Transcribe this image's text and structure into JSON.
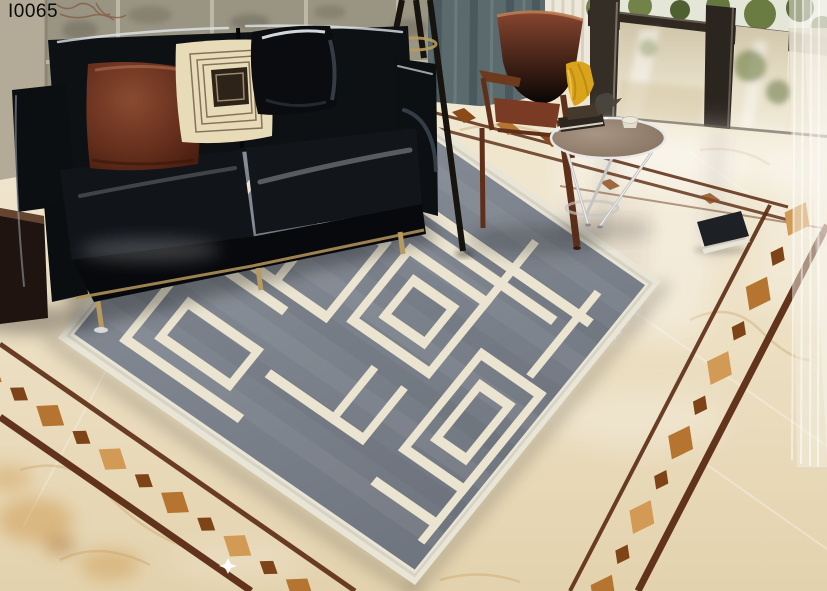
{
  "label": {
    "text": "I0065"
  },
  "palette": {
    "wall_stone": "#9a9583",
    "pillar": "#b3ab97",
    "curtain_teal": "#5b6a6d",
    "curtain_sheer": "#f3efe3",
    "window_frame": "#342e26",
    "greenery": "#66773f",
    "floor_marble": "#ecdfc2",
    "marble_vein": "#c49e5f",
    "border_line_brown": "#5b2b13",
    "border_diamond_gold": "#b5742f",
    "rug_gray": "#7d838d",
    "rug_line": "#eae4d0",
    "rug_edge": "#e9e5d6",
    "sofa_black": "#0e1114",
    "pillow_brown": "#6e3522",
    "pillow_cream": "#e8dbb8",
    "pillow_black": "#0a0c0f",
    "chair_leather": "#7a3b24",
    "chair_wood": "#5f3019",
    "cloth_yellow": "#d9a41c",
    "table_chrome": "#c4c4c4"
  }
}
